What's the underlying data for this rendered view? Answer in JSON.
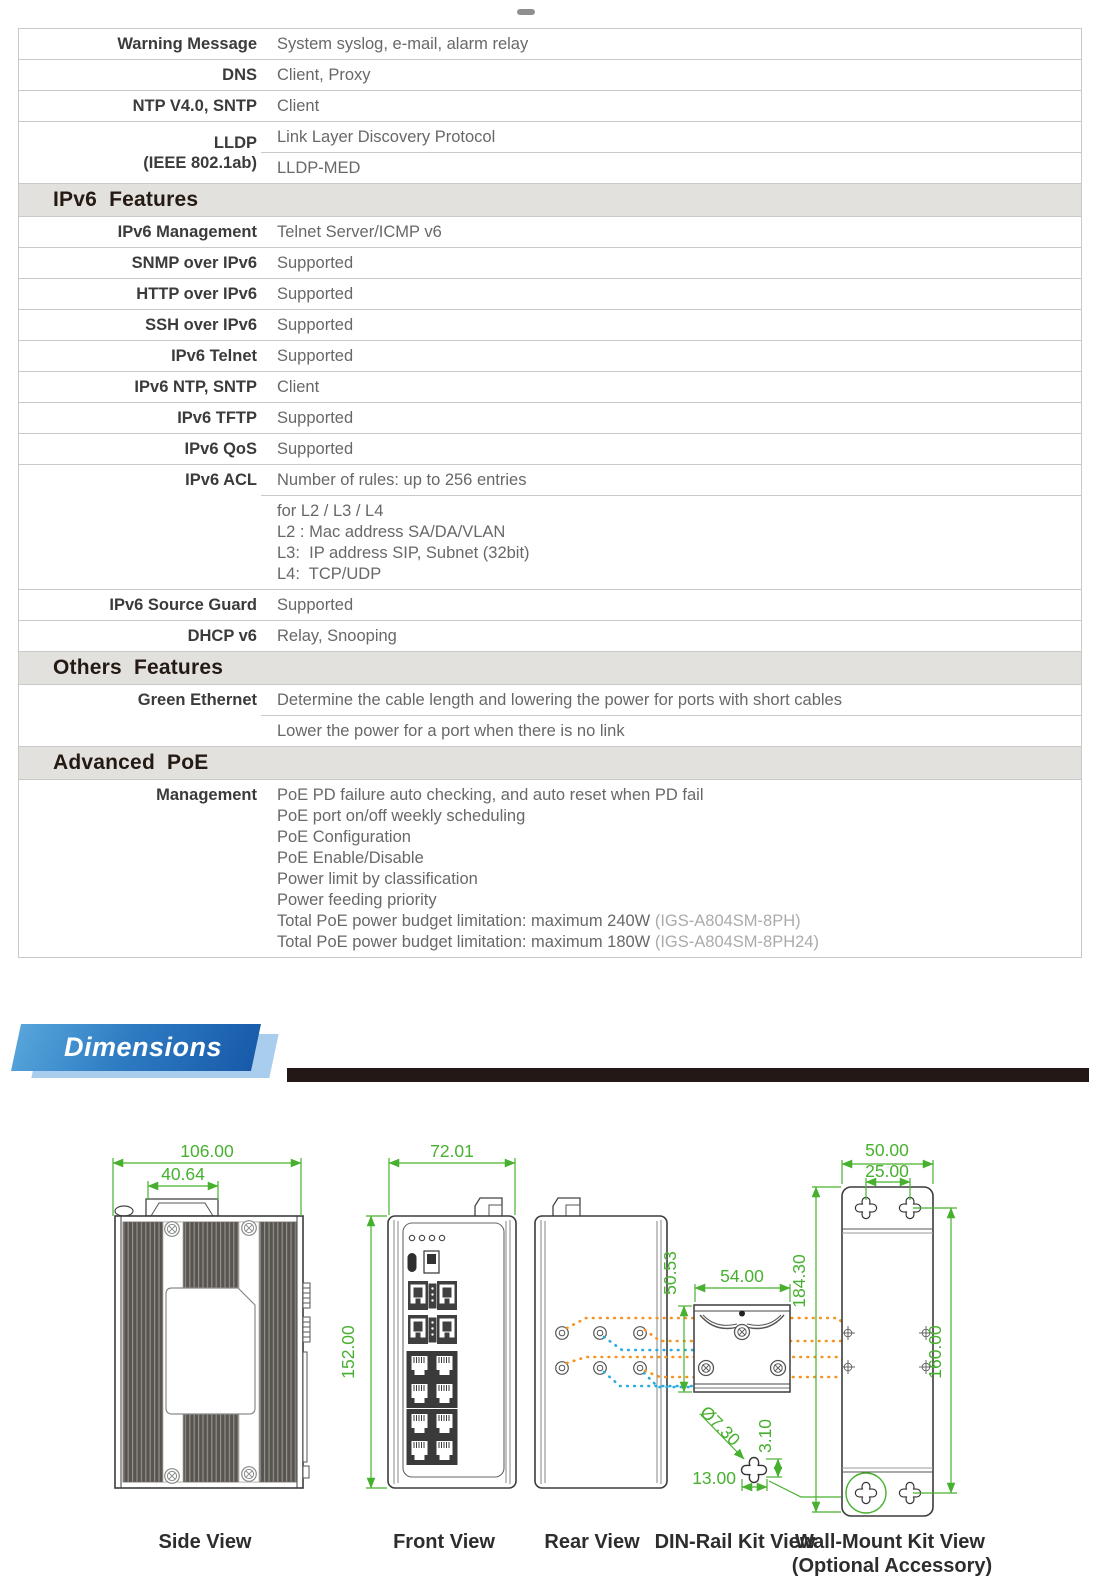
{
  "spec_table": {
    "rows": [
      {
        "type": "row",
        "label": "Warning Message",
        "cells": [
          [
            "System syslog, e-mail, alarm relay"
          ]
        ]
      },
      {
        "type": "row",
        "label": "DNS",
        "cells": [
          [
            "Client, Proxy"
          ]
        ]
      },
      {
        "type": "row",
        "label": "NTP V4.0, SNTP",
        "cells": [
          [
            "Client"
          ]
        ]
      },
      {
        "type": "row",
        "label": [
          "LLDP",
          "(IEEE 802.1ab)"
        ],
        "cells": [
          [
            "Link Layer Discovery Protocol"
          ],
          [
            "LLDP-MED"
          ]
        ]
      },
      {
        "type": "section",
        "label": "IPv6  Features"
      },
      {
        "type": "row",
        "label": "IPv6 Management",
        "cells": [
          [
            "Telnet Server/ICMP v6"
          ]
        ]
      },
      {
        "type": "row",
        "label": "SNMP over IPv6",
        "cells": [
          [
            "Supported"
          ]
        ]
      },
      {
        "type": "row",
        "label": "HTTP over IPv6",
        "cells": [
          [
            "Supported"
          ]
        ]
      },
      {
        "type": "row",
        "label": "SSH over IPv6",
        "cells": [
          [
            "Supported"
          ]
        ]
      },
      {
        "type": "row",
        "label": "IPv6 Telnet",
        "cells": [
          [
            "Supported"
          ]
        ]
      },
      {
        "type": "row",
        "label": "IPv6 NTP, SNTP",
        "cells": [
          [
            "Client"
          ]
        ]
      },
      {
        "type": "row",
        "label": "IPv6 TFTP",
        "cells": [
          [
            "Supported"
          ]
        ]
      },
      {
        "type": "row",
        "label": "IPv6 QoS",
        "cells": [
          [
            "Supported"
          ]
        ]
      },
      {
        "type": "row",
        "label": "IPv6 ACL",
        "cells": [
          [
            "Number of rules: up to 256 entries"
          ],
          [
            "for L2 / L3 / L4",
            "L2 : Mac address SA/DA/VLAN",
            "L3:  IP address SIP, Subnet (32bit)",
            "L4:  TCP/UDP"
          ]
        ]
      },
      {
        "type": "row",
        "label": "IPv6 Source Guard",
        "cells": [
          [
            "Supported"
          ]
        ]
      },
      {
        "type": "row",
        "label": "DHCP v6",
        "cells": [
          [
            "Relay, Snooping"
          ]
        ]
      },
      {
        "type": "section",
        "label": "Others  Features"
      },
      {
        "type": "row",
        "label": "Green Ethernet",
        "cells": [
          [
            "Determine the cable length and lowering the power for ports with short cables"
          ],
          [
            "Lower the power for a port when there is no link"
          ]
        ]
      },
      {
        "type": "section",
        "label": "Advanced  PoE"
      },
      {
        "type": "row",
        "label": "Management",
        "cells": [
          [
            "PoE PD failure auto checking, and auto reset when PD fail",
            "PoE port on/off weekly scheduling",
            "PoE Configuration",
            "PoE Enable/Disable",
            "Power limit by classification",
            "Power feeding priority",
            {
              "text": "Total PoE power budget limitation: maximum 240W ",
              "suffix": "(IGS-A804SM-8PH)"
            },
            {
              "text": "Total PoE power budget limitation: maximum 180W ",
              "suffix": "(IGS-A804SM-8PH24)"
            }
          ]
        ]
      }
    ]
  },
  "dimensions": {
    "banner_label": "Dimensions",
    "views": [
      "Side View",
      "Front View",
      "Rear View",
      "DIN-Rail Kit View",
      "Wall-Mount Kit View"
    ],
    "optional_note": "(Optional Accessory)",
    "dims": {
      "side_width": "106.00",
      "side_clip_width": "40.64",
      "front_width": "72.01",
      "front_height": "152.00",
      "din_height": "50.53",
      "din_width": "54.00",
      "wall_width": "50.00",
      "wall_top_hole_spacing": "25.00",
      "wall_height": "184.30",
      "wall_hole_vertical": "160.00",
      "keyhole_diameter": "Ø7.30",
      "keyhole_notch": "3.10",
      "keyhole_width": "13.00"
    },
    "colors": {
      "dimension_green": "#47b02f",
      "wallmount_orange": "#f6921e",
      "dinrail_blue": "#29abe2",
      "banner_blue": "#175aa9",
      "bar_black": "#231815"
    }
  }
}
